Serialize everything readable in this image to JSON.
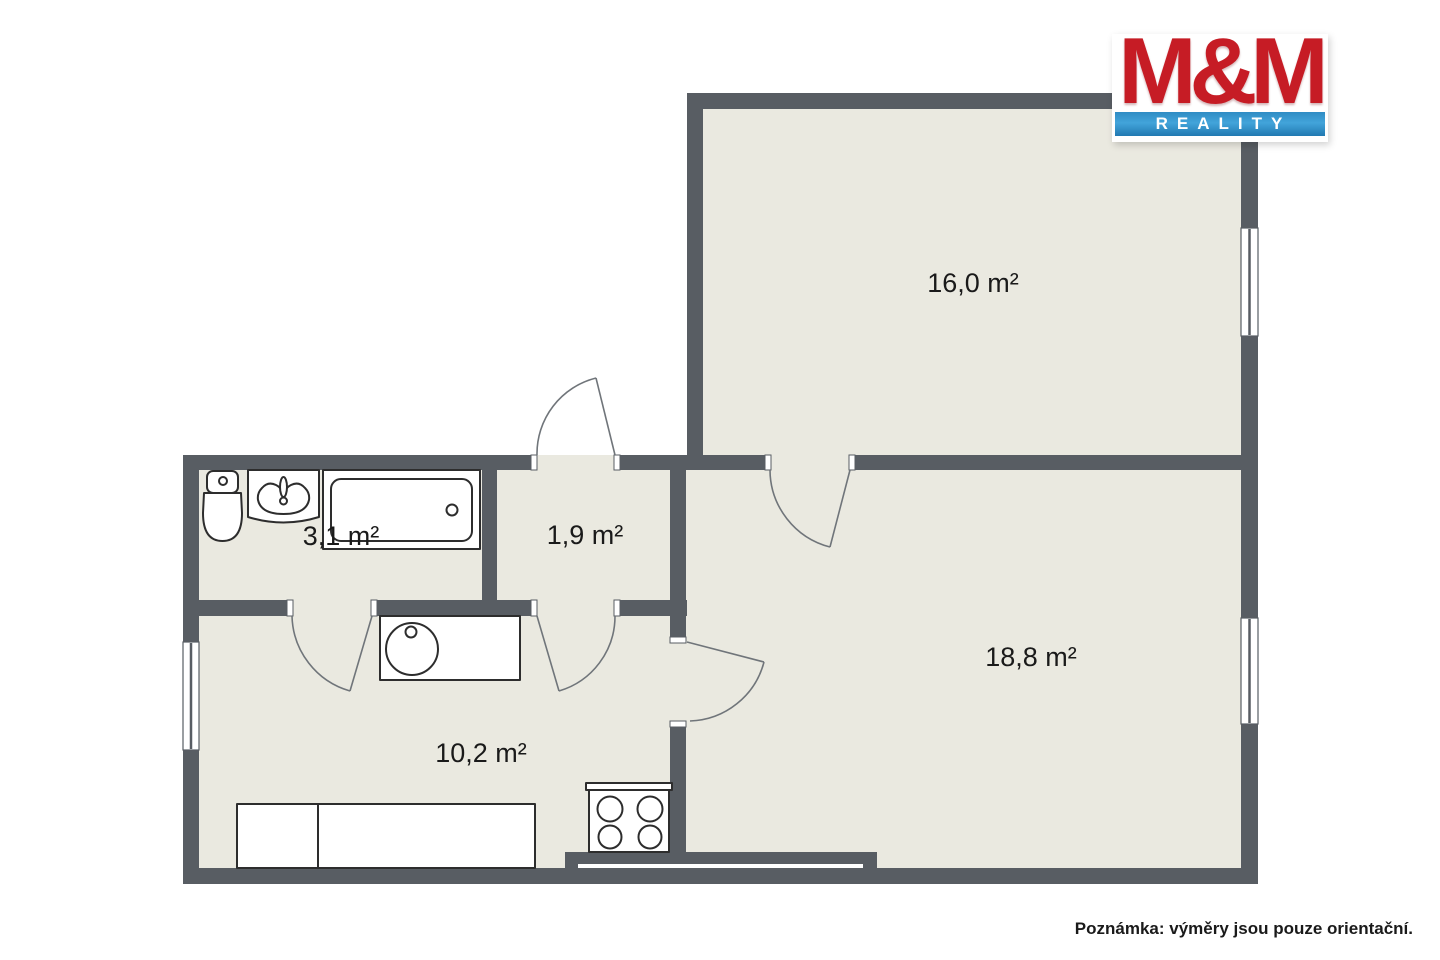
{
  "theme": {
    "floor": "#eae9e0",
    "wall": "#585d63",
    "fixture-outline": "#2d2d2d",
    "door": "#70757a",
    "label": "#1a1a1a",
    "note": "#1a1a1a",
    "logo-red": "#c61c25",
    "logo-blue-top": "#2f8cc4",
    "logo-blue-mid": "#42a4da",
    "logo-blue-bottom": "#2179b1"
  },
  "branding": {
    "title": "M&M",
    "subtitle": "REALITY"
  },
  "rooms": [
    {
      "name": "room-16-0",
      "label": "16,0 m²"
    },
    {
      "name": "room-18-8",
      "label": "18,8 m²"
    },
    {
      "name": "room-10-2",
      "label": "10,2 m²"
    },
    {
      "name": "hall-1-9",
      "label": "1,9 m²"
    },
    {
      "name": "bathroom-3-1",
      "label": "3,1 m²"
    }
  ],
  "fixtures": [
    "toilet",
    "washbasin",
    "bathtub",
    "kitchen-sink",
    "stove",
    "bed"
  ],
  "note_text": "Poznámka: výměry jsou pouze orientační."
}
